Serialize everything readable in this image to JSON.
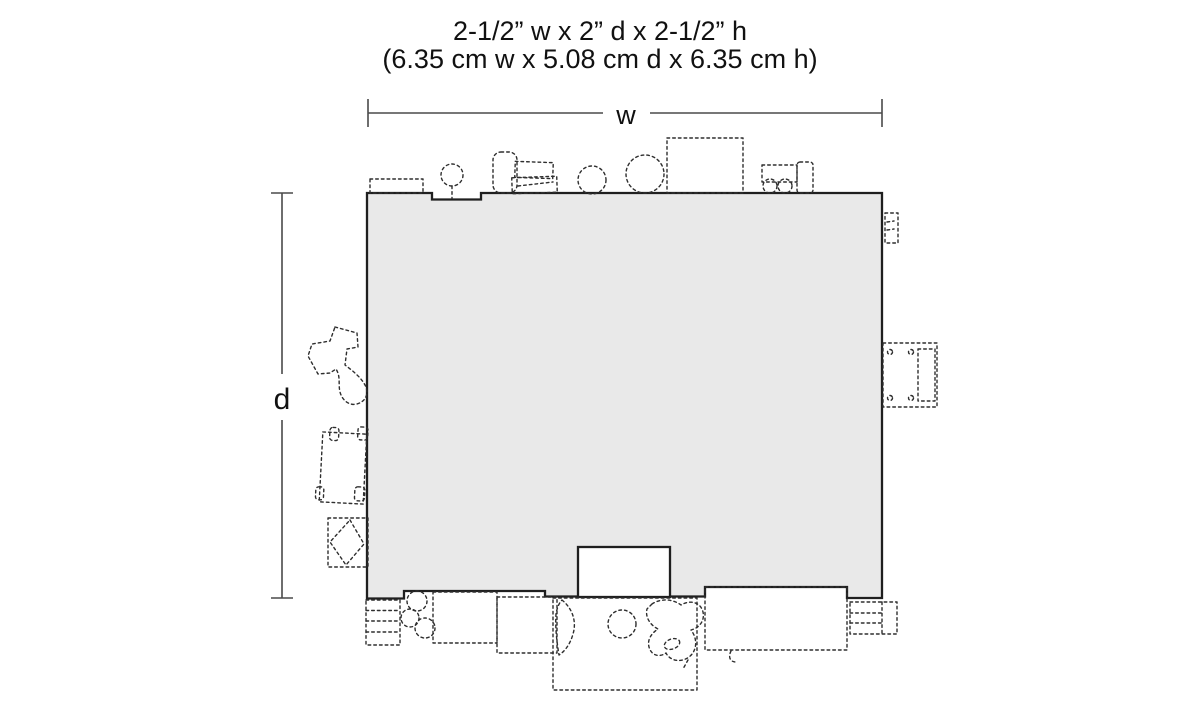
{
  "title": {
    "line1": "2-1/2” w x 2” d x 2-1/2” h",
    "line2": "(6.35 cm w x 5.08 cm d x 6.35 cm h)"
  },
  "dimension_labels": {
    "width": "w",
    "depth": "d"
  },
  "dimensions": {
    "width_imperial": "2-1/2”",
    "depth_imperial": "2”",
    "height_imperial": "2-1/2”",
    "width_metric": "6.35 cm",
    "depth_metric": "5.08 cm",
    "height_metric": "6.35 cm"
  },
  "colors": {
    "background": "#ffffff",
    "footprint_fill": "#e9e9e9",
    "footprint_outline": "#1f1f1f",
    "detail_dash_line": "#2e2e2e",
    "dimension_line": "#4a4a4a",
    "text": "#111111"
  }
}
